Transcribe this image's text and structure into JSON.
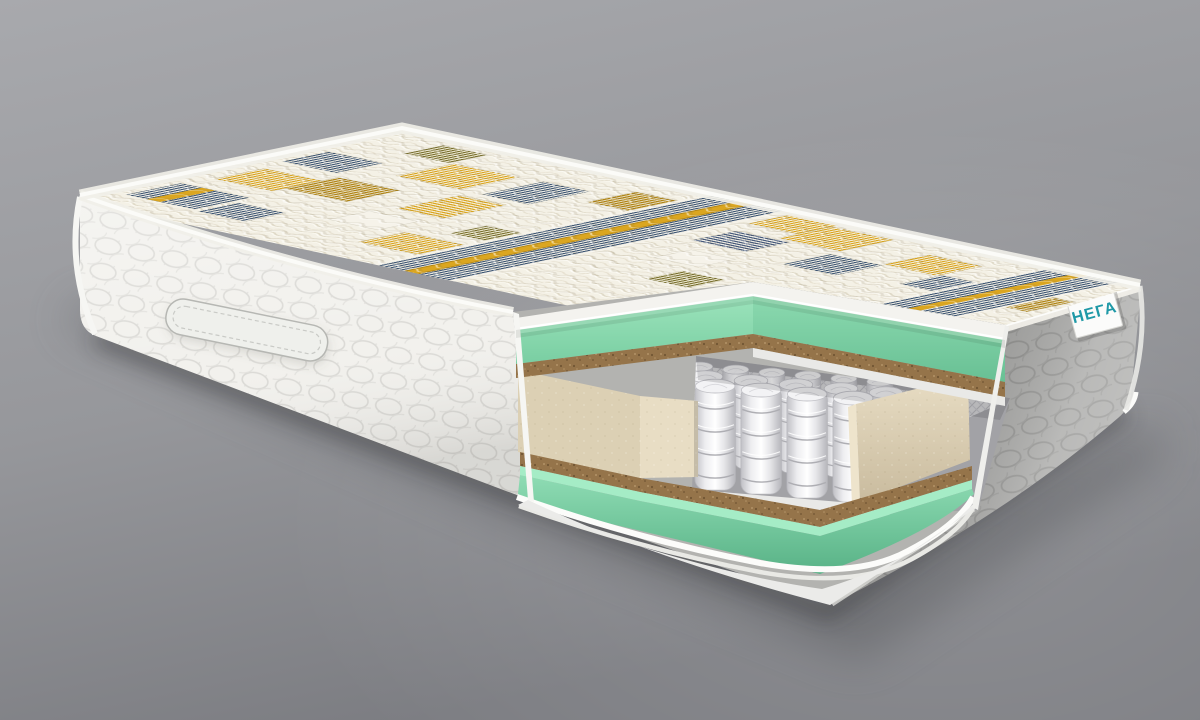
{
  "brand_label": {
    "text": "НЕГА",
    "color": "#1f99a7",
    "background": "#fbfbfa"
  },
  "palette": {
    "background_top": "#a8a9ad",
    "background_bottom": "#7c7d82",
    "floor_shadow": "#505155",
    "fabric_white": "#f2f1ed",
    "fabric_gray": "#a6a6a4",
    "quilt_line": "#dbdad6",
    "top_quilt_cream": "#f4f1e6",
    "stripe_navy": "#3e5674",
    "stripe_gold": "#d9a41f",
    "stripe_gold_dark": "#b08414",
    "stripe_olive": "#79702f",
    "foam_mint_light": "#a5ecc6",
    "foam_mint": "#8fdcb4",
    "foam_mint_dark": "#6fc598",
    "coir_brown": "#95744a",
    "coir_dark": "#6b4f2c",
    "felt_white": "#e9e9e7",
    "foam_beige": "#dcd0b4",
    "foam_beige_light": "#e8ddc4",
    "foam_beige_shade": "#c7b99d",
    "spring_white": "#f3f3f5",
    "spring_shadow": "#b5b5ba",
    "piping_white": "#fcfcfa"
  }
}
